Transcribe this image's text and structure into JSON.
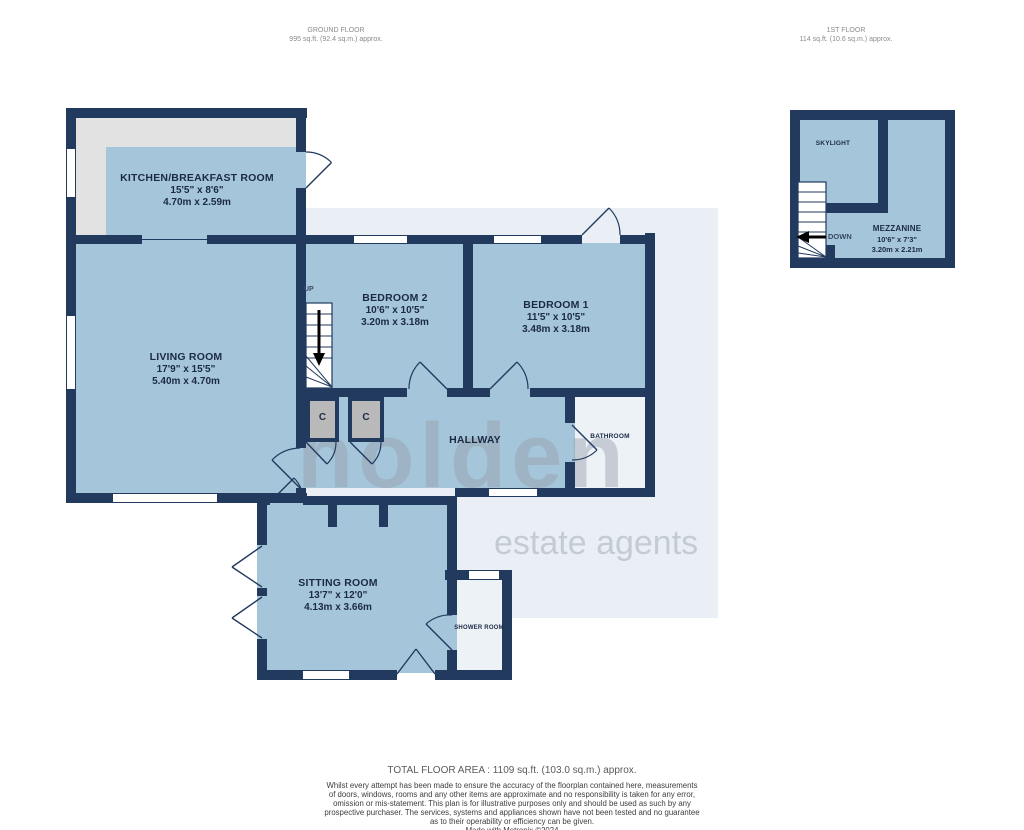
{
  "colors": {
    "wall": "#223a5e",
    "floor": "#a5c6da",
    "pale": "#e9eff5",
    "kitchen-gray": "#e2e2e2",
    "cupboard": "#b9b9b9",
    "wet-floor": "#edf2f7",
    "label": "#1c2a44",
    "muted": "#8b8b8b",
    "footer": "#3d3d3d",
    "watermark": "#96a0ac"
  },
  "headers": {
    "ground": {
      "title": "GROUND FLOOR",
      "area": "995 sq.ft. (92.4 sq.m.) approx."
    },
    "first": {
      "title": "1ST FLOOR",
      "area": "114 sq.ft. (10.6 sq.m.) approx."
    }
  },
  "rooms": {
    "kitchen": {
      "name": "KITCHEN/BREAKFAST ROOM",
      "imperial": "15'5\" x 8'6\"",
      "metric": "4.70m x 2.59m"
    },
    "living": {
      "name": "LIVING ROOM",
      "imperial": "17'9\" x 15'5\"",
      "metric": "5.40m x 4.70m"
    },
    "bedroom2": {
      "name": "BEDROOM 2",
      "imperial": "10'6\" x 10'5\"",
      "metric": "3.20m x 3.18m"
    },
    "bedroom1": {
      "name": "BEDROOM 1",
      "imperial": "11'5\" x 10'5\"",
      "metric": "3.48m x 3.18m"
    },
    "hallway": {
      "name": "HALLWAY"
    },
    "bathroom": {
      "name": "BATHROOM"
    },
    "sitting": {
      "name": "SITTING ROOM",
      "imperial": "13'7\" x 12'0\"",
      "metric": "4.13m x 3.66m"
    },
    "shower": {
      "name": "SHOWER ROOM"
    },
    "skylight": {
      "name": "SKYLIGHT"
    },
    "mezzanine": {
      "name": "MEZZANINE",
      "imperial": "10'6\" x 7'3\"",
      "metric": "3.20m x 2.21m"
    }
  },
  "stairs": {
    "up": "UP",
    "down": "DOWN"
  },
  "cupboard_label": "C",
  "watermark": {
    "line1": "holden",
    "line2": "estate agents"
  },
  "footer": {
    "total": "TOTAL FLOOR AREA : 1109 sq.ft. (103.0 sq.m.) approx.",
    "disclaimer": [
      "Whilst every attempt has been made to ensure the accuracy of the floorplan contained here, measurements",
      "of doors, windows, rooms and any other items are approximate and no responsibility is taken for any error,",
      "omission or mis-statement. This plan is for illustrative purposes only and should be used as such by any",
      "prospective purchaser. The services, systems and appliances shown have not been tested and no guarantee",
      "as to their operability or efficiency can be given.",
      "Made with Metropix ©2024"
    ]
  }
}
